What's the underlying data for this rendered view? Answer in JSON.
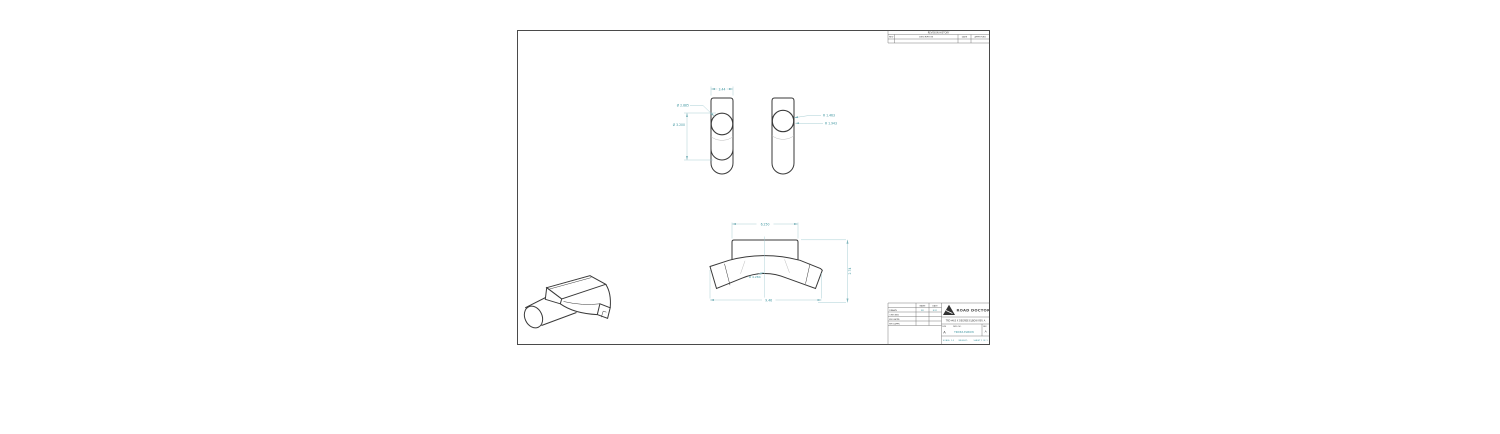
{
  "colors": {
    "dimension_text": "#3f96a0",
    "dimension_line": "#a0c9cf",
    "geometry": "#3a3a3a",
    "sheet_border": "#4a4a4a"
  },
  "revision_table": {
    "title": "REVISION HISTORY",
    "col_rev": "REV",
    "col_description": "DESCRIPTION",
    "col_date": "DATE",
    "col_approved": "APPROVED"
  },
  "dimensions": {
    "side_width": "3.44",
    "side_dia_outer": "Ø 2.885",
    "side_dia_inner": "Ø 3.200",
    "side_r_outer": "R 1.463",
    "side_r_inner": "R 1.943",
    "front_width_top": "6.250",
    "front_height": "2.74",
    "front_radius": "R 4.284",
    "front_width_bottom": "9.46"
  },
  "title_block": {
    "company": "ROAD DOCTORS",
    "drawing_title": "TRD #63 X DEGREE ELBOW REV A",
    "col_name": "NAME",
    "col_date": "DATE",
    "row_drawn": "DRAWN",
    "row_checked": "CHECKED",
    "row_eng": "ENG APPR.",
    "row_mfg": "MFG APPR.",
    "drawn_name": "RD",
    "drawn_date": "8/21",
    "size_label": "SIZE",
    "size_value": "A",
    "dwg_label": "DWG. NO.",
    "dwg_no": "TRD63-ELBOW",
    "rev_label": "REV",
    "rev_value": "A",
    "scale_text": "SCALE: 1:2",
    "weight_text": "WEIGHT:",
    "sheet_text": "SHEET 1 OF 1"
  }
}
